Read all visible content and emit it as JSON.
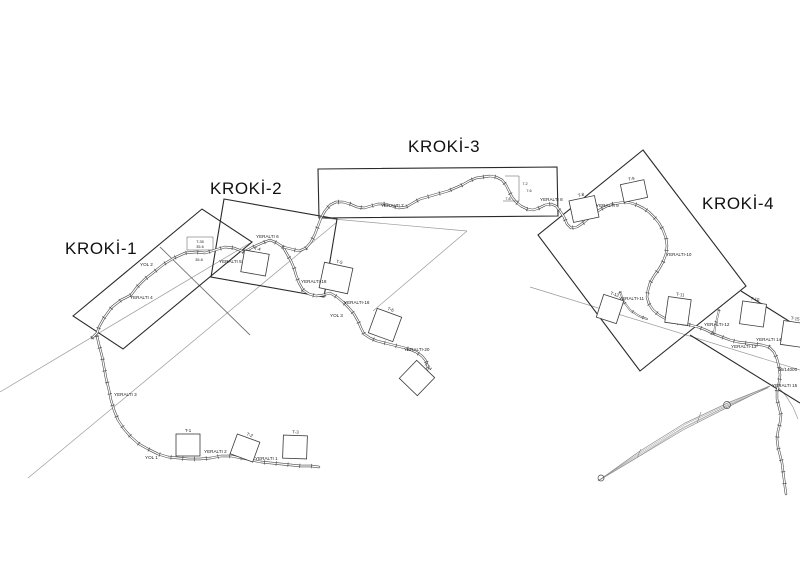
{
  "colors": {
    "frame_line": "#2a2a2a",
    "road_casing": "#4a4a4a",
    "road_core": "#ffffff",
    "reference_line": "#9a9a9a",
    "leader_line": "#777777",
    "spindle_line": "#8a8a8a",
    "text": "#1a1a1a",
    "background": "#ffffff"
  },
  "frames": [
    {
      "label": "KROKİ-1",
      "polygon": [
        [
          73,
          316
        ],
        [
          202,
          209
        ],
        [
          252,
          242
        ],
        [
          123,
          349
        ]
      ],
      "label_x": 65,
      "label_y": 254
    },
    {
      "label": "KROKİ-2",
      "polygon": [
        [
          224,
          199
        ],
        [
          337,
          219
        ],
        [
          324,
          297
        ],
        [
          211,
          277
        ]
      ],
      "label_x": 210,
      "label_y": 194
    },
    {
      "label": "KROKİ-3",
      "polygon": [
        [
          318,
          169
        ],
        [
          557,
          167
        ],
        [
          558,
          216
        ],
        [
          319,
          218
        ]
      ],
      "label_x": 408,
      "label_y": 152
    },
    {
      "label": "KROKİ-4",
      "polygon": [
        [
          643,
          150
        ],
        [
          746,
          286
        ],
        [
          640,
          371
        ],
        [
          538,
          235
        ]
      ],
      "label_x": 702,
      "label_y": 209
    }
  ],
  "partial_frame_lines": [
    [
      [
        741,
        291
      ],
      [
        800,
        328
      ]
    ],
    [
      [
        690,
        335
      ],
      [
        800,
        403
      ]
    ]
  ],
  "reference_lines": [
    [
      [
        28,
        478
      ],
      [
        337,
        222
      ]
    ],
    [
      [
        0,
        392
      ],
      [
        250,
        243
      ]
    ],
    [
      [
        322,
        218
      ],
      [
        467,
        231
      ]
    ],
    [
      [
        467,
        231
      ],
      [
        373,
        311
      ]
    ],
    [
      [
        530,
        287
      ],
      [
        800,
        370
      ]
    ],
    [
      [
        779,
        388
      ],
      [
        786,
        396
      ],
      [
        793,
        407
      ],
      [
        798,
        419
      ]
    ]
  ],
  "leader_lines": [
    [
      [
        160,
        247
      ],
      [
        250,
        335
      ]
    ]
  ],
  "roads": [
    {
      "name": "road-west-climb",
      "minor": false,
      "points": [
        [
          92,
          338
        ],
        [
          97,
          333
        ],
        [
          99,
          327
        ],
        [
          104,
          318
        ],
        [
          112,
          307
        ],
        [
          121,
          300
        ],
        [
          131,
          295
        ],
        [
          137,
          287
        ],
        [
          145,
          279
        ],
        [
          154,
          272
        ],
        [
          164,
          264
        ],
        [
          174,
          258
        ],
        [
          185,
          253
        ],
        [
          196,
          252
        ],
        [
          205,
          253
        ],
        [
          215,
          250
        ],
        [
          225,
          247
        ],
        [
          234,
          248
        ],
        [
          244,
          252
        ],
        [
          253,
          247
        ],
        [
          262,
          243
        ],
        [
          270,
          240
        ],
        [
          277,
          243
        ],
        [
          283,
          247
        ]
      ]
    },
    {
      "name": "road-west-loop",
      "minor": false,
      "points": [
        [
          97,
          336
        ],
        [
          99,
          345
        ],
        [
          102,
          356
        ],
        [
          104,
          367
        ],
        [
          106,
          378
        ],
        [
          109,
          390
        ],
        [
          111,
          400
        ],
        [
          114,
          410
        ],
        [
          118,
          420
        ],
        [
          124,
          429
        ],
        [
          131,
          437
        ],
        [
          139,
          444
        ],
        [
          148,
          449
        ],
        [
          158,
          454
        ],
        [
          168,
          457
        ],
        [
          178,
          458
        ],
        [
          189,
          459
        ],
        [
          200,
          459
        ],
        [
          211,
          458
        ],
        [
          221,
          456
        ],
        [
          231,
          456
        ],
        [
          241,
          458
        ],
        [
          251,
          460
        ],
        [
          261,
          462
        ],
        [
          271,
          463
        ],
        [
          281,
          464
        ],
        [
          291,
          465
        ],
        [
          301,
          466
        ],
        [
          311,
          466
        ],
        [
          319,
          467
        ]
      ]
    },
    {
      "name": "road-south-branch",
      "minor": false,
      "points": [
        [
          283,
          247
        ],
        [
          287,
          254
        ],
        [
          291,
          261
        ],
        [
          294,
          268
        ],
        [
          296,
          275
        ],
        [
          299,
          283
        ],
        [
          303,
          290
        ],
        [
          309,
          294
        ],
        [
          316,
          296
        ],
        [
          323,
          295
        ],
        [
          330,
          293
        ],
        [
          337,
          297
        ],
        [
          343,
          302
        ],
        [
          349,
          308
        ],
        [
          354,
          314
        ],
        [
          358,
          321
        ],
        [
          361,
          328
        ],
        [
          364,
          334
        ],
        [
          370,
          338
        ],
        [
          377,
          341
        ],
        [
          385,
          343
        ],
        [
          393,
          345
        ],
        [
          401,
          347
        ],
        [
          409,
          349
        ],
        [
          416,
          352
        ],
        [
          422,
          356
        ],
        [
          426,
          361
        ],
        [
          428,
          367
        ],
        [
          426,
          372
        ],
        [
          423,
          376
        ]
      ]
    },
    {
      "name": "road-main-northeast",
      "minor": false,
      "points": [
        [
          283,
          247
        ],
        [
          291,
          249
        ],
        [
          299,
          251
        ],
        [
          306,
          248
        ],
        [
          311,
          242
        ],
        [
          315,
          234
        ],
        [
          318,
          226
        ],
        [
          321,
          218
        ],
        [
          325,
          211
        ],
        [
          330,
          205
        ],
        [
          336,
          202
        ],
        [
          343,
          202
        ],
        [
          350,
          204
        ],
        [
          357,
          207
        ],
        [
          364,
          208
        ],
        [
          371,
          206
        ],
        [
          378,
          204
        ],
        [
          385,
          204
        ],
        [
          392,
          206
        ],
        [
          399,
          208
        ],
        [
          406,
          207
        ],
        [
          413,
          203
        ],
        [
          420,
          199
        ],
        [
          427,
          197
        ],
        [
          434,
          195
        ],
        [
          441,
          193
        ],
        [
          448,
          191
        ],
        [
          455,
          188
        ],
        [
          462,
          185
        ],
        [
          469,
          181
        ],
        [
          476,
          178
        ],
        [
          483,
          177
        ],
        [
          490,
          176
        ],
        [
          496,
          177
        ],
        [
          502,
          180
        ],
        [
          506,
          185
        ],
        [
          509,
          191
        ],
        [
          512,
          197
        ],
        [
          516,
          202
        ],
        [
          521,
          206
        ],
        [
          527,
          209
        ],
        [
          533,
          210
        ],
        [
          539,
          208
        ],
        [
          545,
          205
        ],
        [
          551,
          204
        ],
        [
          556,
          206
        ],
        [
          560,
          211
        ],
        [
          564,
          217
        ],
        [
          567,
          224
        ],
        [
          571,
          228
        ],
        [
          577,
          227
        ],
        [
          583,
          223
        ],
        [
          589,
          218
        ],
        [
          595,
          213
        ],
        [
          601,
          209
        ],
        [
          607,
          206
        ],
        [
          613,
          204
        ],
        [
          619,
          203
        ],
        [
          625,
          202
        ],
        [
          631,
          203
        ],
        [
          637,
          205
        ],
        [
          643,
          208
        ],
        [
          649,
          212
        ],
        [
          654,
          217
        ],
        [
          659,
          223
        ],
        [
          663,
          230
        ],
        [
          666,
          238
        ],
        [
          667,
          246
        ],
        [
          666,
          254
        ],
        [
          663,
          262
        ],
        [
          659,
          269
        ],
        [
          654,
          276
        ],
        [
          650,
          283
        ],
        [
          648,
          290
        ],
        [
          647,
          297
        ],
        [
          649,
          304
        ],
        [
          653,
          310
        ],
        [
          659,
          315
        ],
        [
          666,
          319
        ],
        [
          674,
          322
        ],
        [
          682,
          324
        ],
        [
          690,
          325
        ],
        [
          698,
          327
        ],
        [
          706,
          330
        ],
        [
          714,
          334
        ],
        [
          722,
          337
        ],
        [
          730,
          340
        ],
        [
          738,
          342
        ],
        [
          746,
          343
        ],
        [
          754,
          344
        ],
        [
          762,
          345
        ],
        [
          769,
          347
        ],
        [
          774,
          352
        ],
        [
          777,
          359
        ],
        [
          779,
          367
        ],
        [
          780,
          375
        ],
        [
          779,
          383
        ],
        [
          777,
          391
        ],
        [
          777,
          399
        ],
        [
          779,
          407
        ],
        [
          781,
          415
        ],
        [
          780,
          423
        ],
        [
          778,
          431
        ],
        [
          777,
          439
        ],
        [
          778,
          447
        ],
        [
          780,
          455
        ],
        [
          782,
          463
        ],
        [
          783,
          471
        ],
        [
          784,
          479
        ],
        [
          785,
          487
        ],
        [
          786,
          494
        ]
      ]
    },
    {
      "name": "road-spur-1",
      "minor": true,
      "points": [
        [
          620,
          292
        ],
        [
          624,
          302
        ],
        [
          630,
          310
        ],
        [
          639,
          316
        ],
        [
          647,
          319
        ]
      ]
    },
    {
      "name": "road-spur-2",
      "minor": true,
      "points": [
        [
          719,
          310
        ],
        [
          717,
          319
        ],
        [
          715,
          327
        ],
        [
          714,
          334
        ]
      ]
    }
  ],
  "structures": [
    {
      "label": "T-1",
      "cx": 188,
      "cy": 445,
      "w": 24,
      "h": 22,
      "rot": 0
    },
    {
      "label": "T-2",
      "cx": 245,
      "cy": 448,
      "w": 24,
      "h": 21,
      "rot": 20
    },
    {
      "label": "T-3",
      "cx": 295,
      "cy": 447,
      "w": 24,
      "h": 23,
      "rot": 2
    },
    {
      "label": "T-4",
      "cx": 255,
      "cy": 263,
      "w": 25,
      "h": 22,
      "rot": 10
    },
    {
      "label": "T-5",
      "cx": 336,
      "cy": 278,
      "w": 29,
      "h": 26,
      "rot": 12
    },
    {
      "label": "T-6",
      "cx": 385,
      "cy": 325,
      "w": 26,
      "h": 26,
      "rot": 20
    },
    {
      "label": "T-24",
      "cx": 417,
      "cy": 378,
      "w": 25,
      "h": 25,
      "rot": 44
    },
    {
      "label": "T-8",
      "cx": 584,
      "cy": 209,
      "w": 26,
      "h": 22,
      "rot": -12
    },
    {
      "label": "T-9",
      "cx": 634,
      "cy": 191,
      "w": 24,
      "h": 18,
      "rot": -12
    },
    {
      "label": "T-12",
      "cx": 610,
      "cy": 309,
      "w": 21,
      "h": 24,
      "rot": 18
    },
    {
      "label": "T-11",
      "cx": 678,
      "cy": 311,
      "w": 23,
      "h": 26,
      "rot": 8
    },
    {
      "label": "T-10",
      "cx": 753,
      "cy": 314,
      "w": 24,
      "h": 23,
      "rot": 8
    },
    {
      "label": "T-15",
      "cx": 793,
      "cy": 334,
      "w": 22,
      "h": 24,
      "rot": 8
    }
  ],
  "labels": [
    {
      "t": "YOL 2",
      "x": 140,
      "y": 266
    },
    {
      "t": "YERALTI 4",
      "x": 130,
      "y": 299
    },
    {
      "t": "YERALTI 5",
      "x": 219,
      "y": 263
    },
    {
      "t": "YERALTI 6",
      "x": 256,
      "y": 238
    },
    {
      "t": "YERALTI-18",
      "x": 301,
      "y": 283
    },
    {
      "t": "YERALTI-16",
      "x": 344,
      "y": 304
    },
    {
      "t": "YOL 3",
      "x": 330,
      "y": 317
    },
    {
      "t": "YERALTI-20",
      "x": 404,
      "y": 351
    },
    {
      "t": "YERALTI 7",
      "x": 381,
      "y": 207
    },
    {
      "t": "YERALTI 8",
      "x": 540,
      "y": 201
    },
    {
      "t": "YERALTI 9",
      "x": 596,
      "y": 207
    },
    {
      "t": "YERALTI-10",
      "x": 666,
      "y": 256
    },
    {
      "t": "YERALTI-11",
      "x": 619,
      "y": 300
    },
    {
      "t": "YERALTI-12",
      "x": 704,
      "y": 326
    },
    {
      "t": "YERALTI-13",
      "x": 731,
      "y": 348
    },
    {
      "t": "YERALTI 14",
      "x": 756,
      "y": 341
    },
    {
      "t": "YERALTI 3",
      "x": 114,
      "y": 396
    },
    {
      "t": "YOL 1",
      "x": 145,
      "y": 459
    },
    {
      "t": "YERALTI 2",
      "x": 204,
      "y": 453
    },
    {
      "t": "YERALTI 1",
      "x": 255,
      "y": 460
    },
    {
      "t": "16/14000",
      "x": 778,
      "y": 371
    },
    {
      "t": "YERALTI 15",
      "x": 772,
      "y": 387
    }
  ],
  "dims": [
    {
      "shape": [
        [
          187,
          237
        ],
        [
          213,
          237
        ],
        [
          213,
          250
        ],
        [
          187,
          250
        ],
        [
          187,
          237
        ]
      ],
      "texts": [
        {
          "t": "T-35",
          "x": 200,
          "y": 243
        },
        {
          "t": "35.6",
          "x": 200,
          "y": 248
        },
        {
          "t": "35.8",
          "x": 199,
          "y": 261
        }
      ]
    },
    {
      "shape": [
        [
          505,
          176
        ],
        [
          519,
          176
        ],
        [
          519,
          201
        ],
        [
          503,
          201
        ]
      ],
      "texts": [
        {
          "t": "7.2",
          "x": 525,
          "y": 185
        },
        {
          "t": "7.6",
          "x": 529,
          "y": 192
        },
        {
          "t": "7.8",
          "x": 508,
          "y": 200
        }
      ]
    }
  ],
  "spindle": {
    "outline": [
      [
        598,
        481
      ],
      [
        640,
        451
      ],
      [
        685,
        423
      ],
      [
        730,
        402
      ],
      [
        770,
        386
      ],
      [
        728,
        407
      ],
      [
        683,
        430
      ],
      [
        638,
        457
      ]
    ],
    "inner_lines": [
      [
        [
          599,
          480
        ],
        [
          641,
          452
        ],
        [
          686,
          424
        ],
        [
          731,
          403
        ],
        [
          769,
          386
        ]
      ],
      [
        [
          599,
          480
        ],
        [
          640,
          454
        ],
        [
          684,
          427
        ],
        [
          729,
          405
        ],
        [
          769,
          387
        ]
      ],
      [
        [
          598,
          481
        ],
        [
          639,
          456
        ],
        [
          682,
          429
        ],
        [
          727,
          406
        ],
        [
          768,
          388
        ]
      ]
    ],
    "ticks": [
      [
        [
          641,
          449
        ],
        [
          637,
          458
        ]
      ],
      [
        [
          701,
          412
        ],
        [
          697,
          423
        ]
      ]
    ],
    "circles": [
      {
        "cx": 601,
        "cy": 478,
        "r": 3
      },
      {
        "cx": 727,
        "cy": 405,
        "r": 3.5
      }
    ]
  }
}
